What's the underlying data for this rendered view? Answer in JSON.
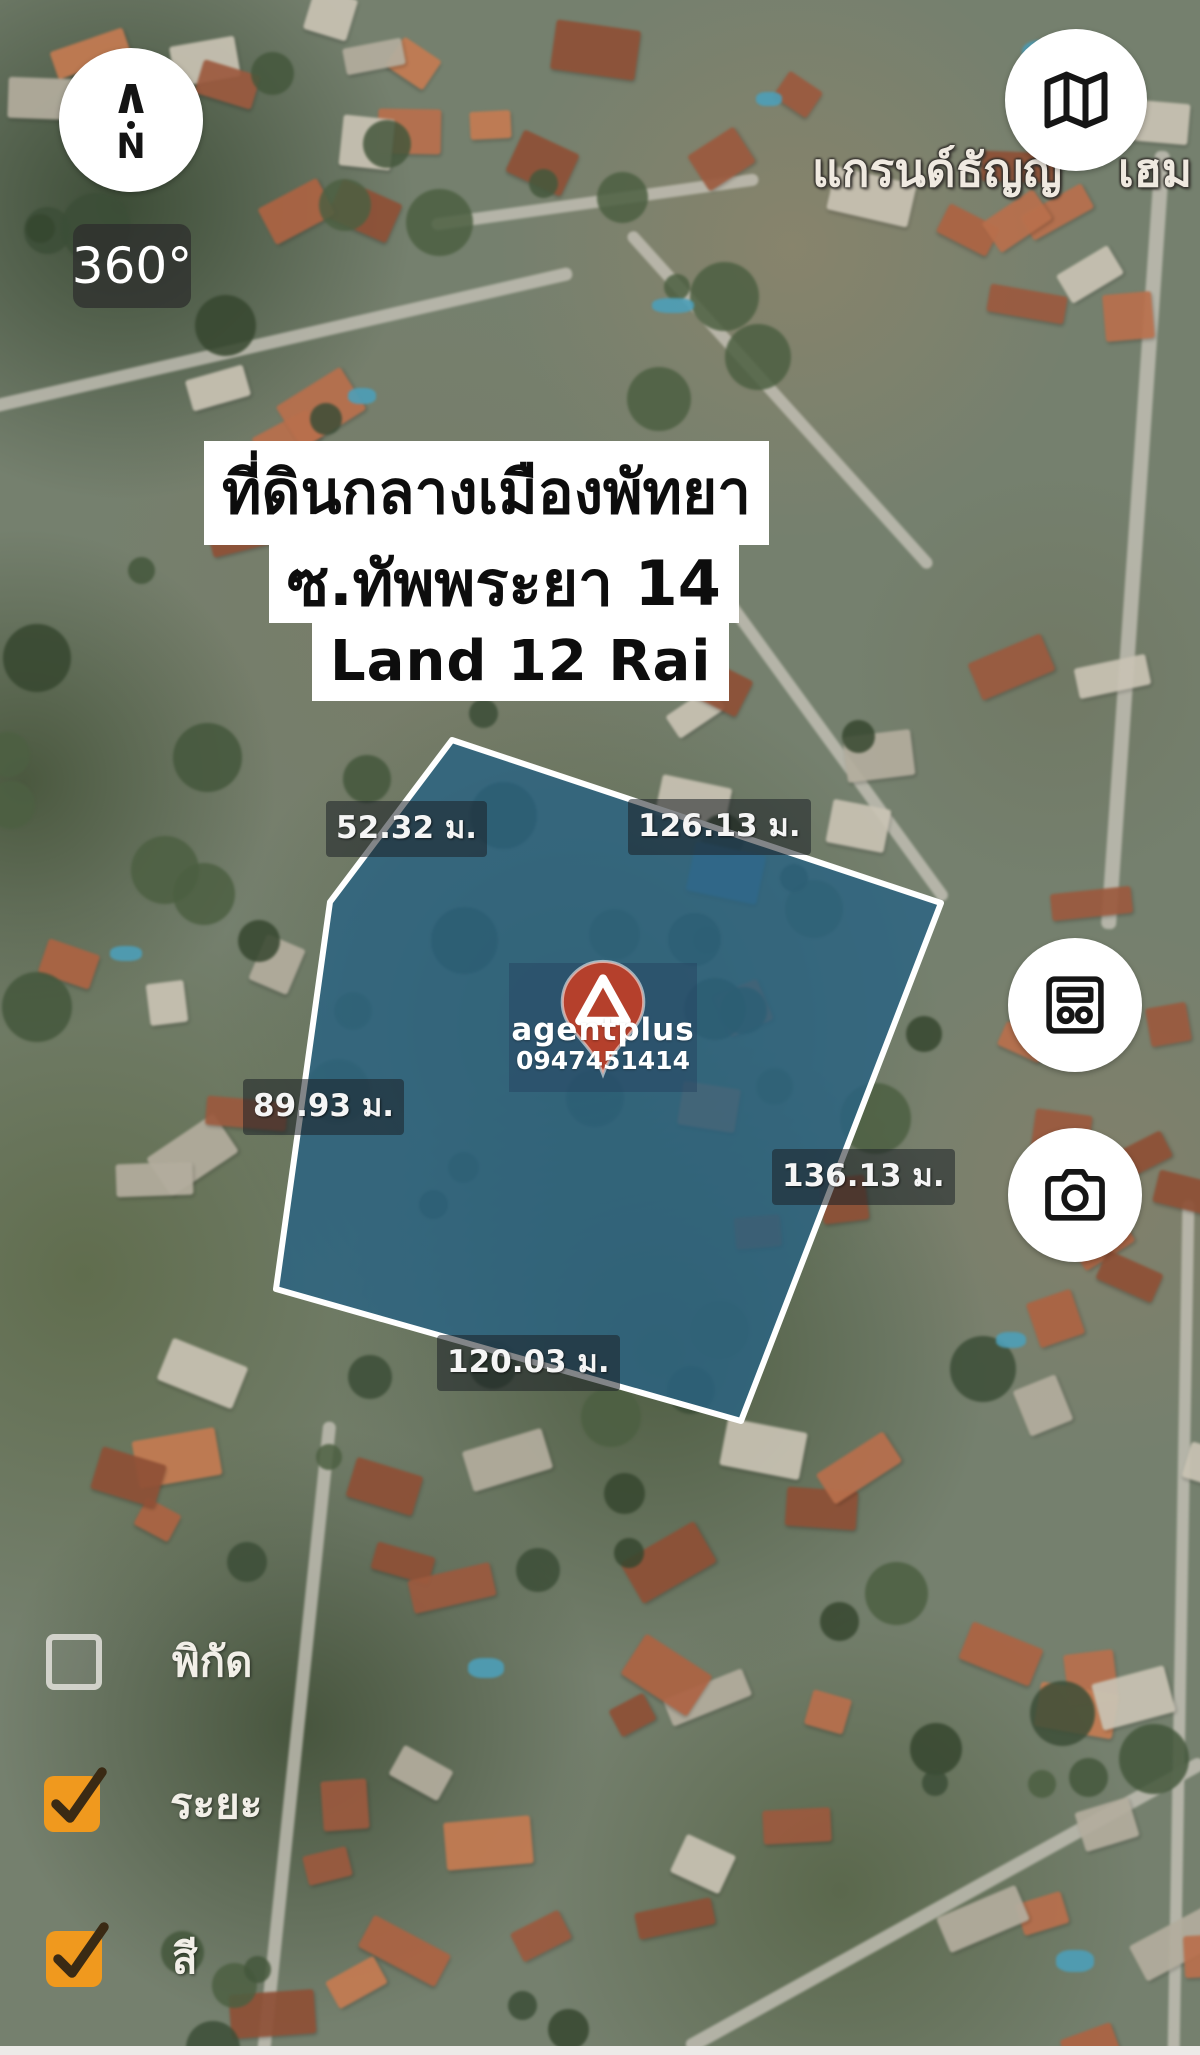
{
  "compass": {
    "arrow_glyph": "∧",
    "north_label": "N"
  },
  "controls": {
    "rotation_label": "360°"
  },
  "place_label": {
    "left": "แกรนด์ธัญญ",
    "right": "เฮม"
  },
  "title_overlay": {
    "line1": "ที่ดินกลางเมืองพัทยา",
    "line2": "ซ.ทัพพระยา 14",
    "line3": "Land 12 Rai"
  },
  "plot": {
    "fill_color": "#2a6382",
    "outline_color": "#ffffff",
    "polygon_points": "452,740 941,903 741,1421 276,1289 330,902",
    "measurements": [
      {
        "side": "upper-left",
        "text": "52.32 ม."
      },
      {
        "side": "upper-right",
        "text": "126.13 ม."
      },
      {
        "side": "left",
        "text": "89.93 ม."
      },
      {
        "side": "right",
        "text": "136.13 ม."
      },
      {
        "side": "bottom",
        "text": "120.03 ม."
      }
    ]
  },
  "watermark": {
    "brand": "agentplus",
    "phone": "0947451414",
    "pin_color": "#b5402c"
  },
  "legend": {
    "checkbox_color": "#f0991e",
    "items": [
      {
        "label": "พิกัด",
        "checked": false
      },
      {
        "label": "ระยะ",
        "checked": true
      },
      {
        "label": "สี",
        "checked": true
      }
    ]
  },
  "icons": {
    "compass": "north-arrow-icon",
    "top_right": "folded-map-icon",
    "side_top": "ballot-card-icon",
    "side_bottom": "camera-icon",
    "watermark": "map-pin-icon",
    "legend_checked": "check-icon"
  }
}
